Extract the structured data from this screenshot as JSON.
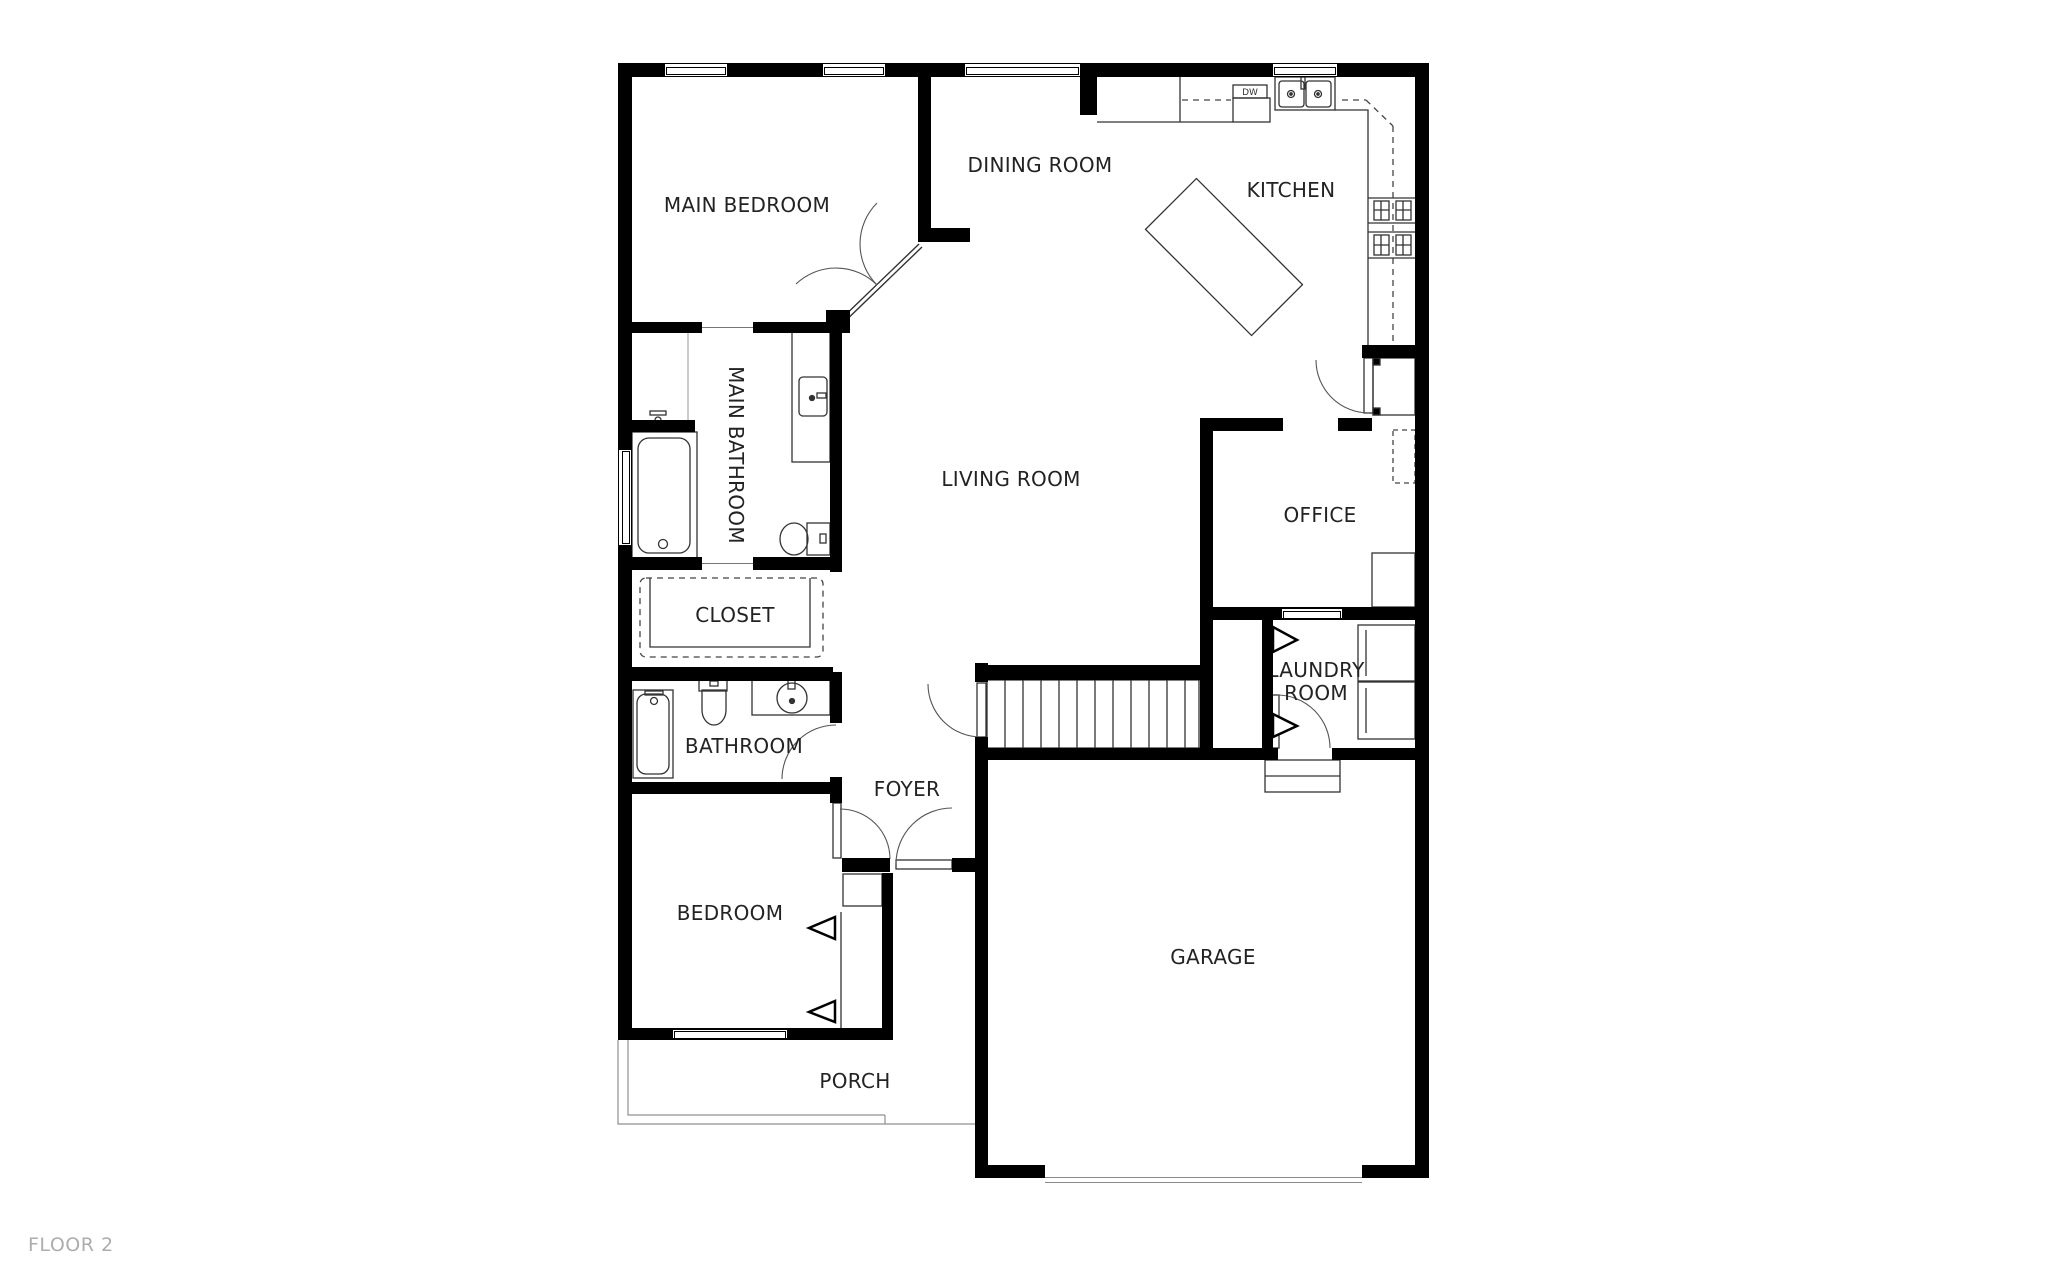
{
  "floor_label": "FLOOR 2",
  "rooms": {
    "main_bedroom": {
      "label": "MAIN BEDROOM"
    },
    "dining_room": {
      "label": "DINING ROOM"
    },
    "kitchen": {
      "label": "KITCHEN"
    },
    "living_room": {
      "label": "LIVING ROOM"
    },
    "main_bathroom": {
      "label": "MAIN BATHROOM"
    },
    "closet": {
      "label": "CLOSET"
    },
    "bathroom": {
      "label": "BATHROOM"
    },
    "foyer": {
      "label": "FOYER"
    },
    "bedroom": {
      "label": "BEDROOM"
    },
    "office": {
      "label": "OFFICE"
    },
    "laundry_room": {
      "label": "LAUNDRY ROOM"
    },
    "garage": {
      "label": "GARAGE"
    },
    "porch": {
      "label": "PORCH"
    }
  },
  "appliances": {
    "dishwasher": "DW"
  },
  "colors": {
    "wall": "#000000",
    "fixture_line": "#333333",
    "label": "#232323",
    "floor_label": "#adadad",
    "background": "#ffffff"
  }
}
